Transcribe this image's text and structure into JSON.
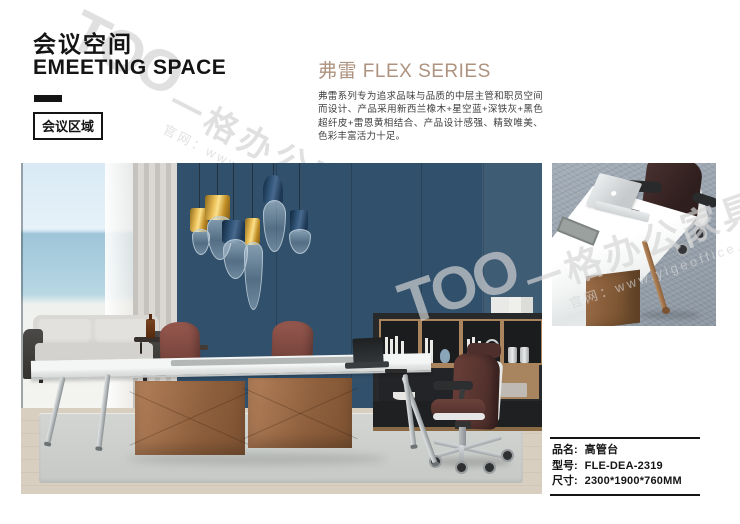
{
  "header": {
    "title_cn": "会议空间",
    "title_en": "EMEETING SPACE",
    "tag": "会议区域"
  },
  "series": {
    "name": "弗雷 FLEX SERIES",
    "description": "弗雷系列专为追求品味与品质的中层主管和职员空间而设计、产品采用新西兰橡木+星空蓝+深铁灰+黑色超纤皮+雷恩黄相结合、产品设计感强、精致唯美、色彩丰富活力十足。"
  },
  "watermark": {
    "logo": "TOO",
    "brand": "一格办公家具",
    "url": "官网：www.yigeoffice.cn"
  },
  "product_info": {
    "rows": [
      {
        "label": "品名:",
        "value": "高管台"
      },
      {
        "label": "型号:",
        "value": "FLE-DEA-2319"
      },
      {
        "label": "尺寸:",
        "value": "2300*1900*760MM"
      }
    ]
  },
  "colors": {
    "accent_tan": "#AE9380",
    "text_black": "#141414",
    "wall_navy": "#31506B",
    "bronze": "#A4714A",
    "burgundy": "#7E4A43",
    "carpet_gray": "#99A3AD",
    "watermark_gray": "#D4D4D4"
  }
}
